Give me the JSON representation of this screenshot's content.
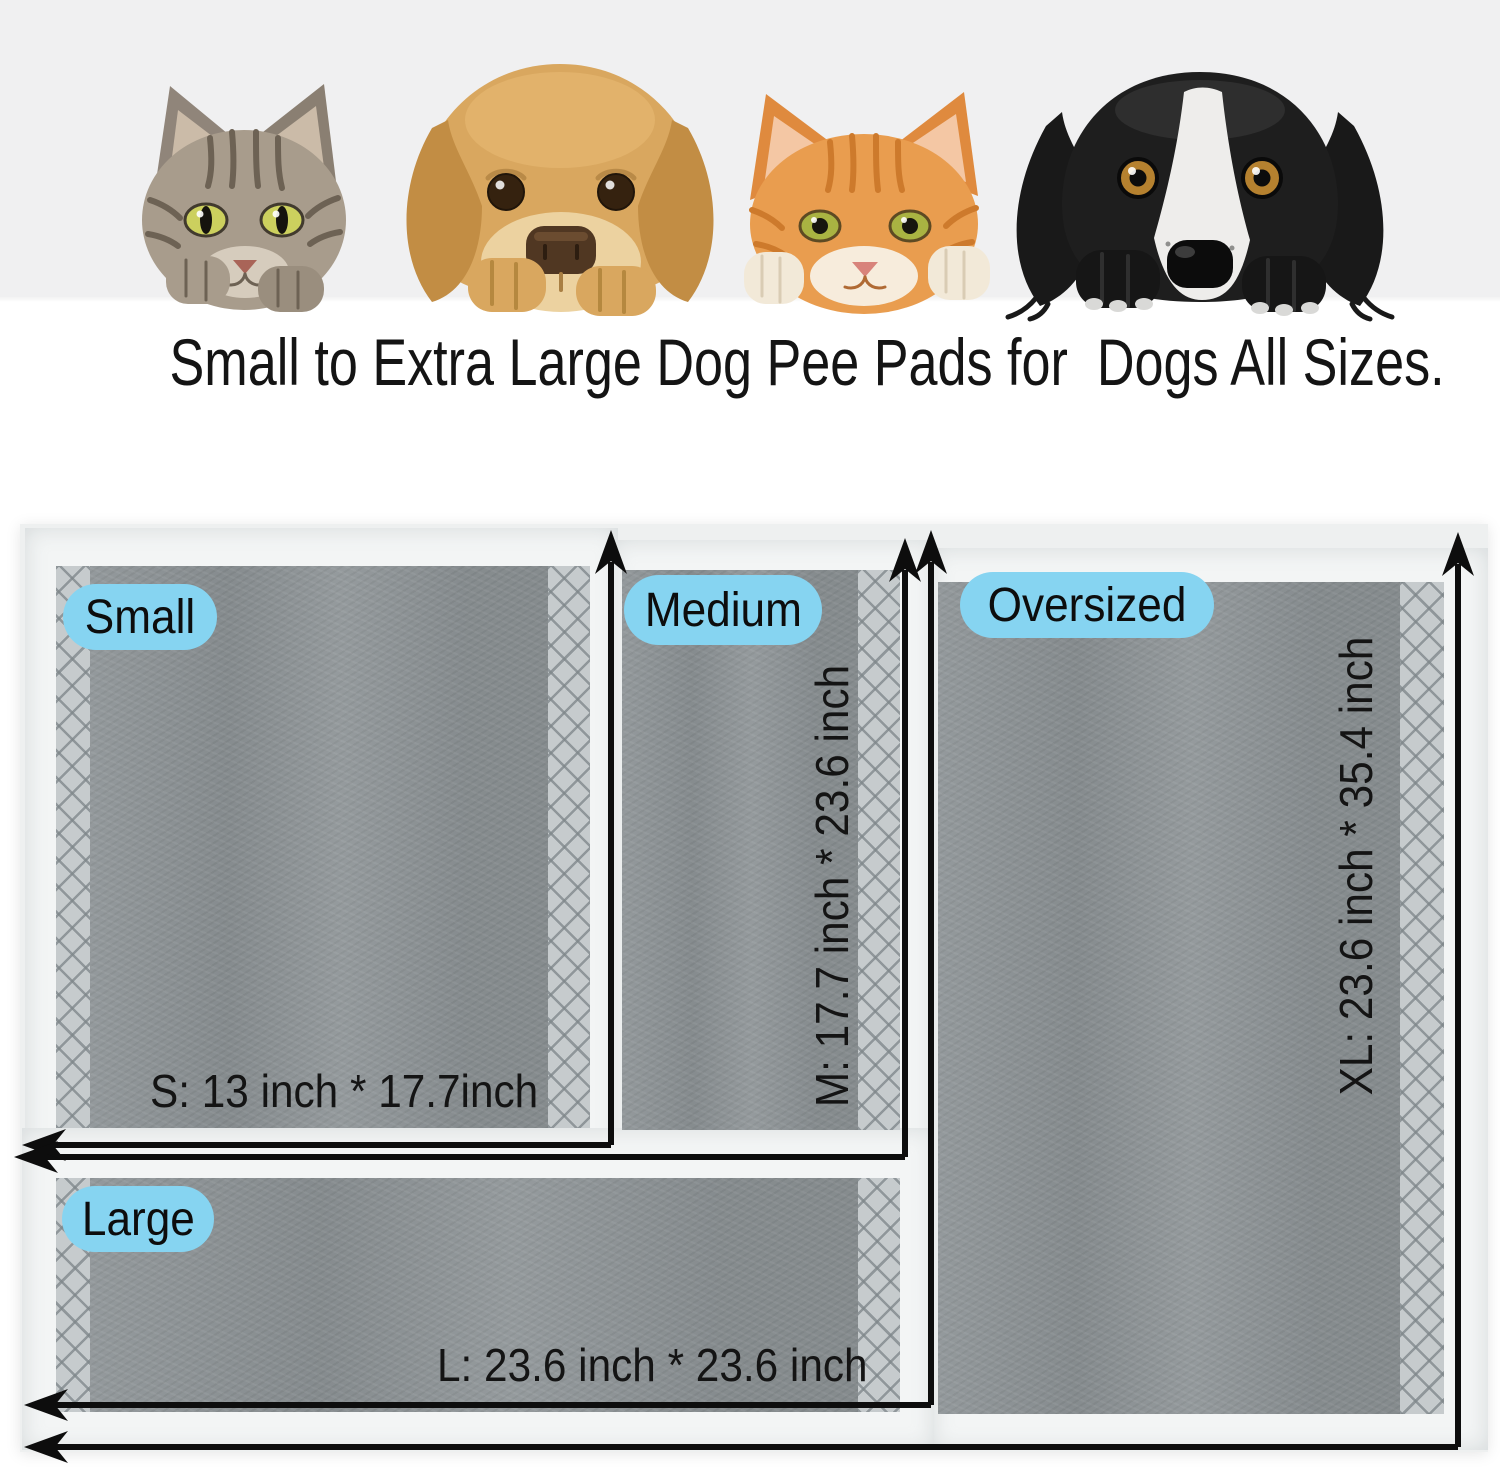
{
  "headline": "Small to Extra Large Dog Pee Pads for  Dogs All Sizes.",
  "hero": {
    "pets": [
      "tabby-cat",
      "golden-retriever",
      "orange-cat",
      "black-and-white-dog"
    ]
  },
  "pads": {
    "small": {
      "label": "Small",
      "size_text": "S: 13 inch * 17.7inch"
    },
    "medium": {
      "label": "Medium",
      "size_text": "M: 17.7 inch * 23.6 inch"
    },
    "large": {
      "label": "Large",
      "size_text": "L: 23.6 inch * 23.6 inch"
    },
    "oversized": {
      "label": "Oversized",
      "size_text": "XL: 23.6 inch * 35.4 inch"
    }
  },
  "colors": {
    "label_pill_bg": "#86d4f1",
    "pad_core_gray": "#8d9396",
    "hatch_gray": "#c6cbcd",
    "sheet_white": "#f3f5f5",
    "arrow_black": "#0d0d0d",
    "hero_bg": "#f0f0f1"
  }
}
